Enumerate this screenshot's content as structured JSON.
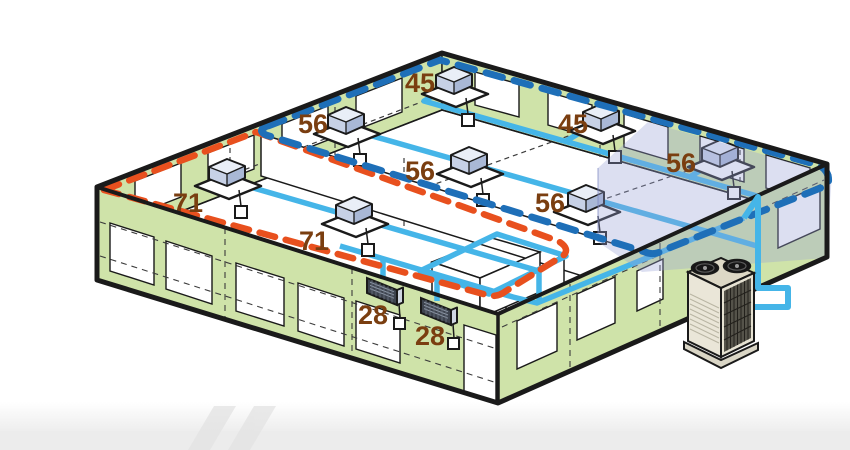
{
  "diagram": {
    "kind": "vrf-hvac-zoning-isometric-building",
    "indoor_units": [
      {
        "id": "cassette-45-a",
        "type": "ceiling-cassette",
        "capacity": "45"
      },
      {
        "id": "cassette-45-b",
        "type": "ceiling-cassette",
        "capacity": "45"
      },
      {
        "id": "cassette-56-a",
        "type": "ceiling-cassette",
        "capacity": "56"
      },
      {
        "id": "cassette-56-b",
        "type": "ceiling-cassette",
        "capacity": "56"
      },
      {
        "id": "cassette-56-c",
        "type": "ceiling-cassette",
        "capacity": "56"
      },
      {
        "id": "cassette-56-d",
        "type": "ceiling-cassette",
        "capacity": "56"
      },
      {
        "id": "cassette-71-a",
        "type": "ceiling-cassette",
        "capacity": "71"
      },
      {
        "id": "cassette-71-b",
        "type": "ceiling-cassette",
        "capacity": "71"
      },
      {
        "id": "wall-unit-28-a",
        "type": "high-wall-unit",
        "capacity": "28"
      },
      {
        "id": "wall-unit-28-b",
        "type": "high-wall-unit",
        "capacity": "28"
      }
    ],
    "outdoor_unit": {
      "id": "outdoor-unit",
      "type": "condensing-unit"
    },
    "zone_boundaries": [
      {
        "id": "zone-blue-dashed",
        "color": "#1e6fb8"
      },
      {
        "id": "zone-red-dashed",
        "color": "#e8501e"
      }
    ],
    "colors": {
      "wall_green": "#cfe3a9",
      "pipe_blue": "#45b5e8",
      "capacity_label_brown": "#7a3e10",
      "highlight_zone_lavender": "#99a1d6",
      "outline_black": "#1a1a1a",
      "footer_gray": "#ececec"
    }
  }
}
